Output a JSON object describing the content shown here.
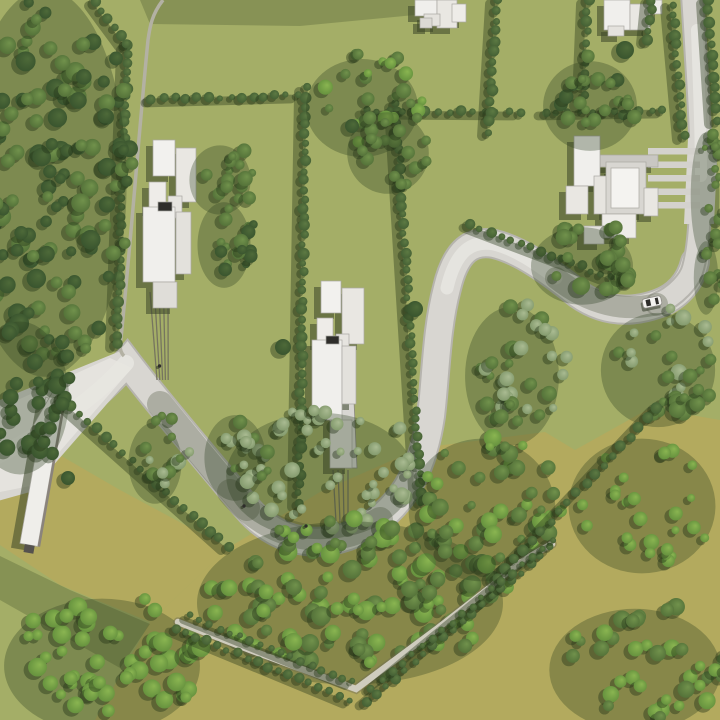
{
  "meta": {
    "description": "aerial-3d-site-plan-render",
    "canvas": {
      "w": 720,
      "h": 720
    }
  },
  "palette": {
    "base": "#a4ae67",
    "olive": "#b3aa5e",
    "oliveShade": "rgba(66,82,40,0.30)",
    "topShade": "rgba(60,75,40,0.28)",
    "roadEdge": "#b6b4ae",
    "road": "#d8d6d1",
    "roadBright": "#e7e5e0",
    "roadShade": "rgba(70,80,52,0.30)",
    "track": "#b3b1a3",
    "path": "#cfccbe",
    "pathEdge": "rgba(110,108,85,0.45)",
    "driveLine": "#76755f",
    "drivePad": "#d8d6d2",
    "driveStrip": "#d4d2cd",
    "building": "#eeece7",
    "buildingEdge": "#a9a7a1",
    "buildingShadow": "rgba(58,70,40,0.55)",
    "dark": "#2e2d2a",
    "carBody": "#f3f2ef",
    "carEdge": "#8e8c86",
    "blobShadow": "rgba(35,52,24,0.42)",
    "clusterShadow": "rgba(45,62,30,0.32)",
    "hedgeShadow": "rgba(42,58,28,0.40)",
    "trees": {
      "dark": [
        "#4e6a39",
        "#35502c"
      ],
      "mid": [
        "#71924c",
        "#4e6b35"
      ],
      "bright": [
        "#8ab551",
        "#5e8a3a"
      ],
      "sage": [
        "#aabb92",
        "#7b9365"
      ],
      "hedge": [
        "#5d7a43",
        "#3f5a31"
      ]
    }
  },
  "scene": {
    "olive_polys": [
      "20,432 120,490 228,548 150,622 60,585 0,545 0,480",
      "150,622 228,548 320,492 420,448 545,432 575,450 650,408 720,420 720,720 95,720"
    ],
    "shade_polys": [
      {
        "pts": "140,0 430,0 425,14 300,26 150,24",
        "fill": "topShade"
      },
      {
        "pts": "0,556 70,590 150,624 120,668 0,600",
        "fill": "oliveShade"
      }
    ],
    "roads": {
      "main": "M -6,462 C 45,435 95,400 127,362 C 152,395 200,452 247,508 C 280,547 330,552 372,524 C 408,500 424,462 431,416 C 436,375 436,330 447,288 C 456,250 472,240 494,244 C 520,250 548,270 578,294 C 606,314 634,312 657,304 C 678,297 690,282 695,262",
      "main_w": 26,
      "right": "M 692,-6 C 696,60 701,130 701,180 C 700,225 698,250 693,268 C 690,280 676,296 657,304",
      "right_w": 20,
      "junction_polys": [
        "0,400 118,352 140,366 30,492 -6,502",
        "688,138 718,138 714,224 684,224"
      ],
      "bright_polys": [
        "0,408 110,358 132,368 30,486 0,492"
      ],
      "highlights": [
        {
          "d": "M -6,458 C 45,432 95,399 126,363",
          "w": 16
        },
        {
          "d": "M 447,288 C 456,250 472,240 494,244 C 515,249 535,263 556,278",
          "w": 13
        },
        {
          "d": "M 697,30 C 699,90 701,130 701,176",
          "w": 12
        }
      ],
      "shades": [
        {
          "d": "M 160,404 C 195,447 220,478 247,508",
          "w": 26
        },
        {
          "d": "M 230,492 C 270,540 330,552 380,520",
          "w": 26
        },
        {
          "d": "M 556,278 C 590,305 625,312 657,304",
          "w": 22
        }
      ]
    },
    "track": {
      "d": "M 163,0 C 152,14 150,26 148,40 C 140,120 131,240 121,338 C 119,346 120,352 124,356",
      "w": 3.5
    },
    "bottom_path": {
      "d": "M 178,622 L 250,650 L 356,689 L 438,628 L 492,586 C 520,560 538,552 552,544",
      "w": 6.5
    },
    "driveways": {
      "d1_lines": [
        [
          150,
          292,
          157,
          380
        ],
        [
          154.5,
          292,
          159.8,
          380
        ],
        [
          159,
          292,
          162.6,
          380
        ],
        [
          163.5,
          292,
          165.4,
          380
        ],
        [
          168,
          292,
          168.2,
          380
        ]
      ],
      "d2_pad": "329,378 353,378 357,468 333,468",
      "d2_lines": [
        [
          333,
          470,
          336,
          522
        ],
        [
          338,
          470,
          340,
          522
        ],
        [
          343,
          470,
          344,
          522
        ],
        [
          348,
          470,
          348,
          522
        ]
      ],
      "d3_strips": [
        [
          648,
          148,
          52,
          6.5
        ],
        [
          648,
          161.5,
          52,
          6.5
        ],
        [
          648,
          175,
          52,
          6.5
        ],
        [
          648,
          188.5,
          52,
          6.5
        ],
        [
          648,
          202,
          52,
          6.5
        ]
      ],
      "d3_dark": [
        649,
        193,
        9,
        6
      ]
    },
    "hedgerows": [
      {
        "name": "left-boundary",
        "x1": 128,
        "y1": 46,
        "x2": 117,
        "y2": 344,
        "n": 36,
        "r": 4.5
      },
      {
        "name": "left-upper-diag",
        "x1": 96,
        "y1": 2,
        "x2": 127,
        "y2": 44,
        "n": 6,
        "r": 4.5
      },
      {
        "name": "center-left",
        "x1": 306,
        "y1": 88,
        "x2": 299,
        "y2": 503,
        "n": 46,
        "r": 4.5
      },
      {
        "name": "center-right",
        "x1": 396,
        "y1": 104,
        "x2": 421,
        "y2": 502,
        "n": 44,
        "r": 4.5
      },
      {
        "name": "top-row-1",
        "x1": 152,
        "y1": 99,
        "x2": 298,
        "y2": 95,
        "n": 14,
        "r": 4
      },
      {
        "name": "top-row-2",
        "x1": 366,
        "y1": 111,
        "x2": 520,
        "y2": 112,
        "n": 14,
        "r": 4
      },
      {
        "name": "top-row-3",
        "x1": 545,
        "y1": 112,
        "x2": 663,
        "y2": 110,
        "n": 11,
        "r": 4
      },
      {
        "name": "topright-a",
        "x1": 497,
        "y1": 0,
        "x2": 489,
        "y2": 132,
        "n": 14,
        "r": 4.5
      },
      {
        "name": "topright-b",
        "x1": 588,
        "y1": 0,
        "x2": 584,
        "y2": 96,
        "n": 10,
        "r": 4.5
      },
      {
        "name": "topright-c",
        "x1": 652,
        "y1": 0,
        "x2": 648,
        "y2": 40,
        "n": 5,
        "r": 4.5
      },
      {
        "name": "road-left",
        "x1": 672,
        "y1": 4,
        "x2": 684,
        "y2": 136,
        "n": 14,
        "r": 4.5
      },
      {
        "name": "road-right",
        "x1": 708,
        "y1": 0,
        "x2": 716,
        "y2": 120,
        "n": 12,
        "r": 4.5
      },
      {
        "name": "olive-left",
        "x1": 62,
        "y1": 398,
        "x2": 228,
        "y2": 546,
        "n": 20,
        "r": 4.5
      },
      {
        "name": "bend-outer",
        "x1": 470,
        "y1": 224,
        "x2": 612,
        "y2": 278,
        "n": 15,
        "r": 4
      },
      {
        "name": "diag-right",
        "x1": 657,
        "y1": 408,
        "x2": 497,
        "y2": 578,
        "n": 19,
        "r": 4.5,
        "late": true
      },
      {
        "name": "path-side-a1",
        "x1": 176,
        "y1": 628,
        "x2": 350,
        "y2": 700,
        "n": 18,
        "r": 4,
        "late": true
      },
      {
        "name": "path-side-a2",
        "x1": 190,
        "y1": 616,
        "x2": 352,
        "y2": 682,
        "n": 17,
        "r": 3.5,
        "late": true
      },
      {
        "name": "path-side-b1",
        "x1": 366,
        "y1": 702,
        "x2": 550,
        "y2": 548,
        "n": 20,
        "r": 4,
        "late": true
      },
      {
        "name": "path-side-b2",
        "x1": 372,
        "y1": 688,
        "x2": 552,
        "y2": 540,
        "n": 19,
        "r": 3.5,
        "late": true
      }
    ],
    "tree_clusters": [
      {
        "name": "left-forest",
        "cx": 55,
        "cy": 175,
        "rx": 80,
        "ry": 190,
        "n": 130,
        "pal": [
          "dark",
          "mid"
        ],
        "rmin": 5,
        "rmax": 10
      },
      {
        "name": "left-forest-low",
        "cx": 30,
        "cy": 390,
        "rx": 48,
        "ry": 75,
        "n": 34,
        "pal": [
          "dark"
        ],
        "rmin": 5,
        "rmax": 9
      },
      {
        "name": "midleft-trees-a",
        "cx": 230,
        "cy": 172,
        "rx": 30,
        "ry": 34,
        "n": 15,
        "pal": [
          "mid"
        ],
        "rmin": 4,
        "rmax": 8
      },
      {
        "name": "midleft-trees-b",
        "cx": 234,
        "cy": 237,
        "rx": 26,
        "ry": 42,
        "n": 16,
        "pal": [
          "mid",
          "dark"
        ],
        "rmin": 4,
        "rmax": 8
      },
      {
        "name": "top-center",
        "cx": 372,
        "cy": 100,
        "rx": 55,
        "ry": 48,
        "n": 26,
        "pal": [
          "bright",
          "mid"
        ],
        "rmin": 4,
        "rmax": 8
      },
      {
        "name": "top-center-b",
        "cx": 398,
        "cy": 145,
        "rx": 40,
        "ry": 40,
        "n": 16,
        "pal": [
          "mid"
        ],
        "rmin": 4,
        "rmax": 7
      },
      {
        "name": "topright-field",
        "cx": 600,
        "cy": 98,
        "rx": 46,
        "ry": 44,
        "n": 22,
        "pal": [
          "mid",
          "dark"
        ],
        "rmin": 4,
        "rmax": 8
      },
      {
        "name": "bend-inner-big",
        "cx": 592,
        "cy": 258,
        "rx": 50,
        "ry": 38,
        "n": 26,
        "pal": [
          "mid"
        ],
        "rmin": 5,
        "rmax": 9
      },
      {
        "name": "right-below-road",
        "cx": 668,
        "cy": 362,
        "rx": 56,
        "ry": 56,
        "n": 30,
        "pal": [
          "mid",
          "sage"
        ],
        "rmin": 4,
        "rmax": 9
      },
      {
        "name": "s-inner",
        "cx": 522,
        "cy": 368,
        "rx": 46,
        "ry": 68,
        "n": 34,
        "pal": [
          "sage",
          "mid"
        ],
        "rmin": 4,
        "rmax": 8
      },
      {
        "name": "sage-u",
        "cx": 330,
        "cy": 468,
        "rx": 92,
        "ry": 62,
        "n": 48,
        "pal": [
          "sage"
        ],
        "rmin": 4,
        "rmax": 8
      },
      {
        "name": "road-left-flank",
        "cx": 165,
        "cy": 455,
        "rx": 26,
        "ry": 40,
        "n": 14,
        "pal": [
          "sage",
          "mid"
        ],
        "rmin": 4,
        "rmax": 8
      },
      {
        "name": "road-right-flank",
        "cx": 245,
        "cy": 450,
        "rx": 30,
        "ry": 42,
        "n": 16,
        "pal": [
          "sage",
          "mid"
        ],
        "rmin": 4,
        "rmax": 8
      },
      {
        "name": "bottom-forest",
        "cx": 360,
        "cy": 595,
        "rx": 150,
        "ry": 80,
        "n": 115,
        "pal": [
          "bright",
          "mid"
        ],
        "rmin": 5,
        "rmax": 10
      },
      {
        "name": "bottom-forest-b",
        "cx": 492,
        "cy": 502,
        "rx": 72,
        "ry": 70,
        "n": 48,
        "pal": [
          "mid",
          "bright"
        ],
        "rmin": 4,
        "rmax": 9
      },
      {
        "name": "bottom-left",
        "cx": 112,
        "cy": 658,
        "rx": 96,
        "ry": 66,
        "n": 52,
        "pal": [
          "bright"
        ],
        "rmin": 5,
        "rmax": 10
      },
      {
        "name": "olive-scatter",
        "cx": 652,
        "cy": 498,
        "rx": 72,
        "ry": 66,
        "n": 26,
        "pal": [
          "bright"
        ],
        "rmin": 4,
        "rmax": 8
      },
      {
        "name": "bottomright",
        "cx": 645,
        "cy": 662,
        "rx": 84,
        "ry": 60,
        "n": 38,
        "pal": [
          "bright",
          "mid"
        ],
        "rmin": 5,
        "rmax": 9
      },
      {
        "name": "rightedge-strip",
        "cx": 715,
        "cy": 188,
        "rx": 14,
        "ry": 62,
        "n": 14,
        "pal": [
          "mid"
        ],
        "rmin": 3,
        "rmax": 6
      },
      {
        "name": "rightedge-low",
        "cx": 716,
        "cy": 270,
        "rx": 12,
        "ry": 36,
        "n": 10,
        "pal": [
          "mid"
        ],
        "rmin": 4,
        "rmax": 7
      }
    ],
    "single_trees": [
      {
        "x": 283,
        "y": 347,
        "r": 8
      },
      {
        "x": 415,
        "y": 309,
        "r": 8
      },
      {
        "x": 68,
        "y": 478,
        "r": 7
      },
      {
        "x": 352,
        "y": 126,
        "r": 7
      },
      {
        "x": 625,
        "y": 50,
        "r": 9
      }
    ],
    "buildings": [
      {
        "name": "house-top-a",
        "rects": [
          [
            415,
            0,
            22,
            16,
            "#f0efec"
          ],
          [
            437,
            0,
            20,
            28,
            "#e9e7e2"
          ],
          [
            424,
            14,
            16,
            12,
            "#e4e2dd"
          ],
          [
            452,
            4,
            14,
            18,
            "#eeece8"
          ],
          [
            420,
            18,
            12,
            10,
            "#dcdad5"
          ]
        ]
      },
      {
        "name": "house-top-b",
        "rects": [
          [
            604,
            0,
            26,
            30,
            "#f0efec"
          ],
          [
            630,
            4,
            20,
            26,
            "#e9e7e2"
          ],
          [
            608,
            26,
            16,
            10,
            "#e4e2dd"
          ],
          [
            650,
            0,
            12,
            14,
            "#eeece8"
          ]
        ]
      },
      {
        "name": "house-west",
        "rects": [
          [
            153,
            140,
            22,
            36,
            "#f2f1ee"
          ],
          [
            176,
            148,
            20,
            54,
            "#e9e7e2"
          ],
          [
            149,
            182,
            17,
            28,
            "#eeece8"
          ],
          [
            168,
            196,
            14,
            22,
            "#e6e4df"
          ],
          [
            143,
            207,
            32,
            75,
            "#f0efec"
          ],
          [
            176,
            212,
            15,
            62,
            "#e3e1dc"
          ],
          [
            158,
            202,
            14,
            9,
            "#2e2d2a"
          ],
          [
            153,
            282,
            24,
            26,
            "#dfddd8"
          ]
        ]
      },
      {
        "name": "house-center",
        "rects": [
          [
            321,
            281,
            20,
            32,
            "#f2f1ee"
          ],
          [
            342,
            288,
            22,
            56,
            "#e9e7e2"
          ],
          [
            317,
            318,
            16,
            26,
            "#eeece8"
          ],
          [
            336,
            334,
            13,
            20,
            "#e6e4df"
          ],
          [
            312,
            340,
            30,
            80,
            "#f0efec"
          ],
          [
            342,
            346,
            14,
            58,
            "#e3e1dc"
          ],
          [
            326,
            336,
            13,
            8,
            "#2e2d2a"
          ],
          [
            330,
            420,
            22,
            48,
            "#dfddd8"
          ]
        ]
      },
      {
        "name": "house-east",
        "rects": [
          [
            600,
            155,
            58,
            12,
            "#c9c7c2"
          ],
          [
            574,
            136,
            26,
            50,
            "#f0efec"
          ],
          [
            566,
            186,
            22,
            28,
            "#e9e7e2"
          ],
          [
            594,
            176,
            16,
            38,
            "#e6e4df"
          ],
          [
            606,
            162,
            40,
            52,
            "#d8d6d1"
          ],
          [
            611,
            168,
            28,
            40,
            "#f4f3f0"
          ],
          [
            644,
            188,
            14,
            28,
            "#e9e7e2"
          ],
          [
            602,
            214,
            34,
            24,
            "#eeece8"
          ],
          [
            584,
            226,
            20,
            18,
            "#e4e2dd"
          ]
        ]
      }
    ],
    "slab": {
      "main": {
        "x": 33,
        "y": 398,
        "w": 18,
        "h": 148,
        "rot": 10,
        "cx": 42,
        "cy": 470
      },
      "edge": {
        "x": 51,
        "y": 398,
        "w": 2.5,
        "h": 148
      },
      "top": {
        "x": 44,
        "y": 390,
        "w": 14,
        "h": 40,
        "rot": 30,
        "cx": 48,
        "cy": 408
      },
      "foot": {
        "x": 38,
        "y": 546,
        "w": 10,
        "h": 8,
        "fill": "#55524e"
      }
    },
    "car": {
      "x": 652,
      "y": 302,
      "angle": -12,
      "len": 19,
      "wid": 9.5
    },
    "people": [
      {
        "x": 159.5,
        "y": 366
      },
      {
        "x": 306,
        "y": 526
      },
      {
        "x": 244,
        "y": 506
      }
    ]
  }
}
